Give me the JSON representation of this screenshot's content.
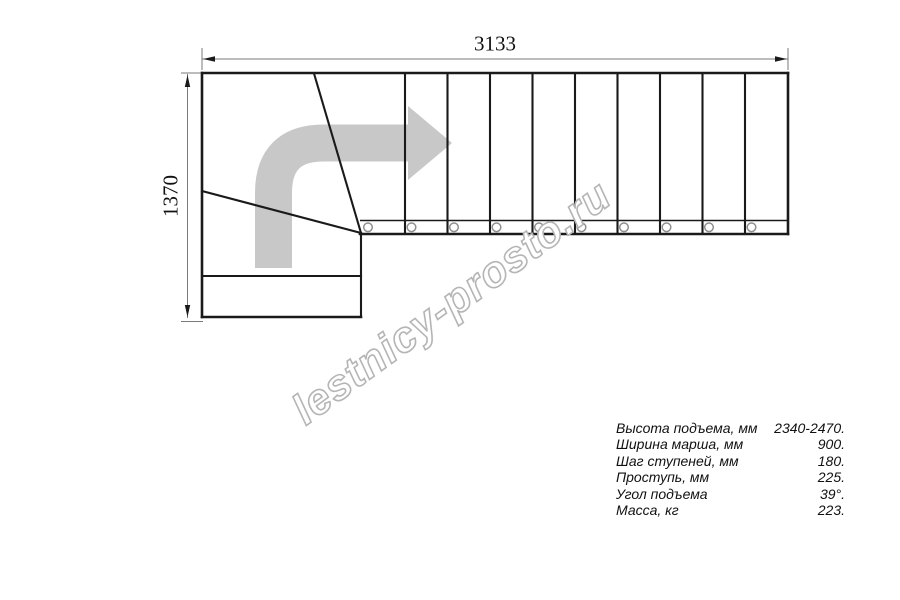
{
  "drawing": {
    "title": "L-shaped staircase plan (top view)",
    "dimensions": {
      "width_label": "3133",
      "height_label": "1370"
    },
    "watermark": "lestnicy-prosto.ru",
    "specs": {
      "rows": [
        {
          "label": "Высота подъема, мм",
          "value": "2340-2470."
        },
        {
          "label": "Ширина марша, мм",
          "value": "900."
        },
        {
          "label": "Шаг ступеней, мм",
          "value": "180."
        },
        {
          "label": "Проступь, мм",
          "value": "225."
        },
        {
          "label": "Угол подъема",
          "value": "39°."
        },
        {
          "label": "Масса, кг",
          "value": "223."
        }
      ]
    },
    "colors": {
      "line": "#1a1a1a",
      "dim": "#7a7a7a",
      "arrow": "#c8c8c8",
      "watermark": "#b5b5b5"
    }
  }
}
